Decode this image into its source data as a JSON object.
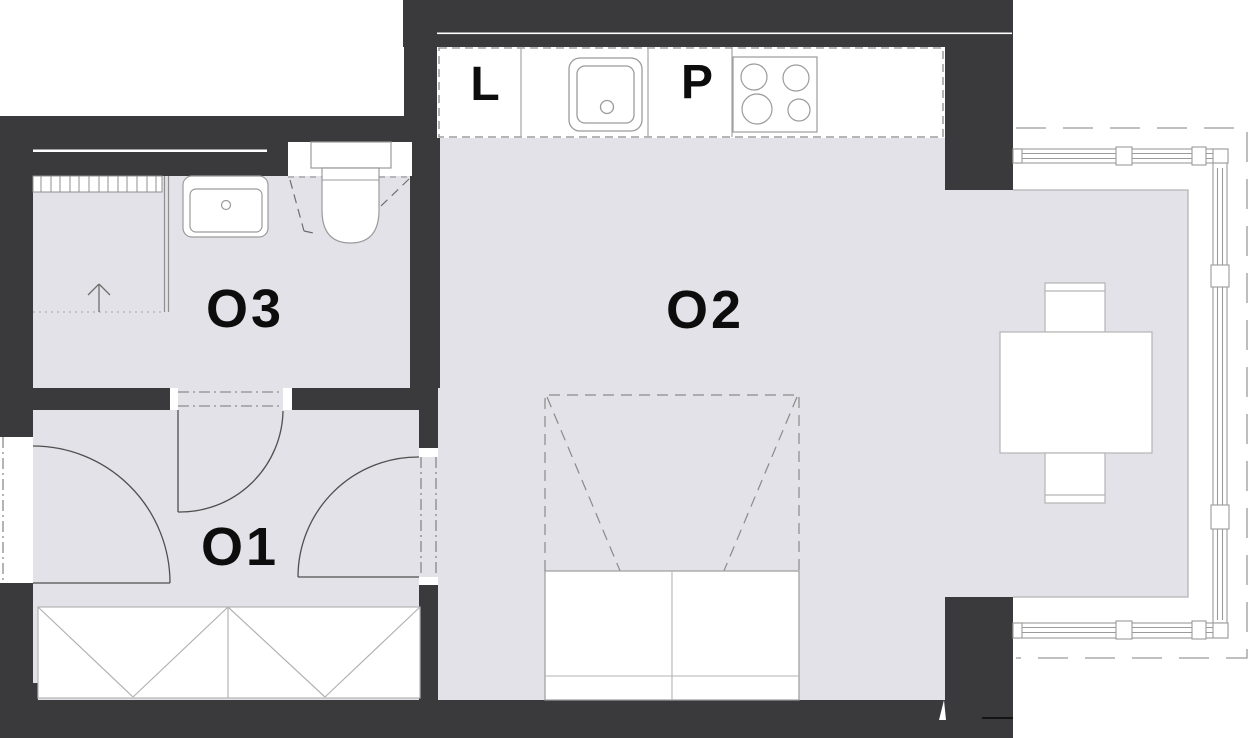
{
  "document": {
    "type": "apartment-floor-plan",
    "units_shown": [
      "O1",
      "O2",
      "O3"
    ]
  },
  "labels": {
    "room1": "O1",
    "room2": "O2",
    "room3": "O3",
    "kitchen_left": "L",
    "kitchen_right": "P"
  },
  "colors": {
    "wall": "#3a3a3c",
    "floor": "#e3e2e8",
    "fixture_outline": "#9b9b9b",
    "light_outline": "#b5b5b5",
    "door_line": "#4f4f4f",
    "dash_line": "#8a8a8a",
    "text": "#0d0d0d",
    "background": "#ffffff"
  },
  "fixtures": {
    "kitchen": [
      "fridge-slot",
      "kitchen-sink",
      "hob-4-burners",
      "counter-outline"
    ],
    "bathroom": [
      "shower-tray",
      "shower-glass",
      "drain-grate",
      "slope-arrow",
      "washbasin",
      "toilet"
    ],
    "hallway": [
      "entrance-door",
      "wardrobe"
    ],
    "living": [
      "folding-bed-dashed",
      "bed-cabinet"
    ],
    "balcony": [
      "dining-table",
      "chair-top",
      "chair-bottom",
      "glazing-frames",
      "roof-overhang-dashed"
    ]
  }
}
